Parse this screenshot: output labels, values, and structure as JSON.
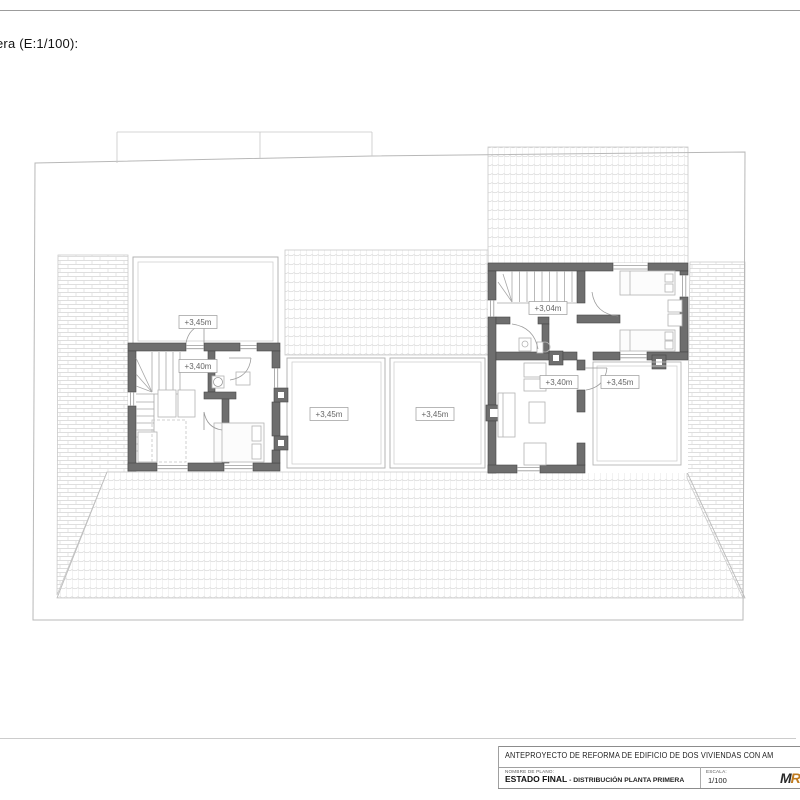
{
  "page": {
    "scale_note": "era (E:1/100):"
  },
  "plan": {
    "levels": {
      "left_terrace": "+3,45m",
      "left_house_hall": "+3,40m",
      "terrace_mid_left": "+3,45m",
      "terrace_mid_right": "+3,45m",
      "right_house_landing": "+3,04m",
      "right_house_living": "+3,40m",
      "right_terrace": "+3,45m"
    }
  },
  "title_block": {
    "project_title": "ANTEPROYECTO DE REFORMA DE EDIFICIO DE DOS VIVIENDAS CON AM",
    "name_label": "NOMBRE DE PLANO:",
    "plan_name": "ESTADO FINAL",
    "plan_name_suffix": " - DISTRIBUCIÓN PLANTA PRIMERA",
    "scale_label": "ESCALA:",
    "scale_value": "1/100",
    "logo_text": "M",
    "logo_accent": "R",
    "accent_color": "#c07b1f"
  }
}
